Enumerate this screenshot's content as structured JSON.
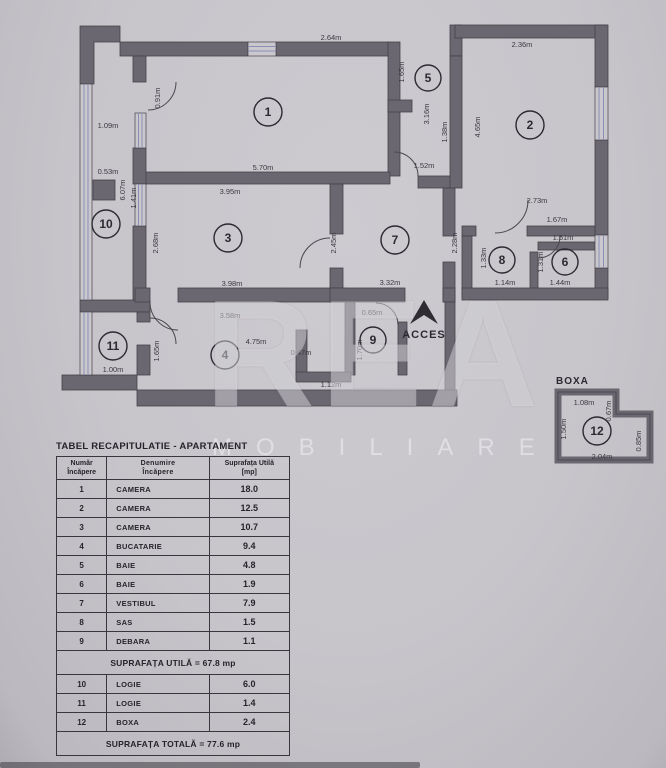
{
  "watermark": {
    "big": "REA",
    "small": "MOBILIARE"
  },
  "plan": {
    "acces_label": "ACCES",
    "boxa_title": "BOXA",
    "room_numbers": [
      "1",
      "2",
      "3",
      "4",
      "5",
      "6",
      "7",
      "8",
      "9",
      "10",
      "11",
      "12"
    ],
    "dims": {
      "r1_top": "2.64m",
      "r1_bottom": "5.70m",
      "r1_door": "0.91m",
      "l10_width": "1.09m",
      "l10_pillar": "0.53m",
      "l10_len": "6.07m",
      "l10_seg": "1.41m",
      "r3_top": "3.95m",
      "r3_left": "2.68m",
      "r3_bottom": "3.98m",
      "r3_right": "2.45m",
      "r5_top": "1.65m",
      "r5_mid": "3.16m",
      "r5_right": "1.38m",
      "r5_bottom": "1.52m",
      "r2_top": "2.36m",
      "r2_left": "4.65m",
      "r2_bottom": "2.73m",
      "hall_a": "1.67m",
      "hall_b": "1.51m",
      "r8_left": "1.33m",
      "r8_bottom": "1.14m",
      "r6_left": "1.31m",
      "r6_bottom": "1.44m",
      "r7_right": "2.28m",
      "r7_bottom": "3.32m",
      "r9_top": "0.65m",
      "r9_left": "1.70m",
      "r4_top": "3.58m",
      "r4_mid": "4.75m",
      "r4_right": "0.47m",
      "r4_corner": "1.12m",
      "r11_bottom": "1.00m",
      "r11_right": "1.65m",
      "b_top": "1.08m",
      "b_step": "0.67m",
      "b_left": "1.50m",
      "b_right": "0.85m",
      "b_bottom": "2.04m"
    }
  },
  "table": {
    "title": "TABEL RECAPITULATIE - APARTAMENT",
    "headers": {
      "col1": [
        "Număr",
        "Încăpere"
      ],
      "col2": [
        "Denumire",
        "Încăpere"
      ],
      "col3": [
        "Suprafața Utilă",
        "[mp]"
      ]
    },
    "rows": [
      {
        "nr": "1",
        "name": "CAMERA",
        "area": "18.0"
      },
      {
        "nr": "2",
        "name": "CAMERA",
        "area": "12.5"
      },
      {
        "nr": "3",
        "name": "CAMERA",
        "area": "10.7"
      },
      {
        "nr": "4",
        "name": "BUCATARIE",
        "area": "9.4"
      },
      {
        "nr": "5",
        "name": "BAIE",
        "area": "4.8"
      },
      {
        "nr": "6",
        "name": "BAIE",
        "area": "1.9"
      },
      {
        "nr": "7",
        "name": "VESTIBUL",
        "area": "7.9"
      },
      {
        "nr": "8",
        "name": "SAS",
        "area": "1.5"
      },
      {
        "nr": "9",
        "name": "DEBARA",
        "area": "1.1"
      }
    ],
    "subtotal": "SUPRAFAȚA UTILĂ = 67.8 mp",
    "annex_rows": [
      {
        "nr": "10",
        "name": "LOGIE",
        "area": "6.0"
      },
      {
        "nr": "11",
        "name": "LOGIE",
        "area": "1.4"
      },
      {
        "nr": "12",
        "name": "BOXA",
        "area": "2.4"
      }
    ],
    "total": "SUPRAFAȚA TOTALĂ = 77.6 mp"
  }
}
